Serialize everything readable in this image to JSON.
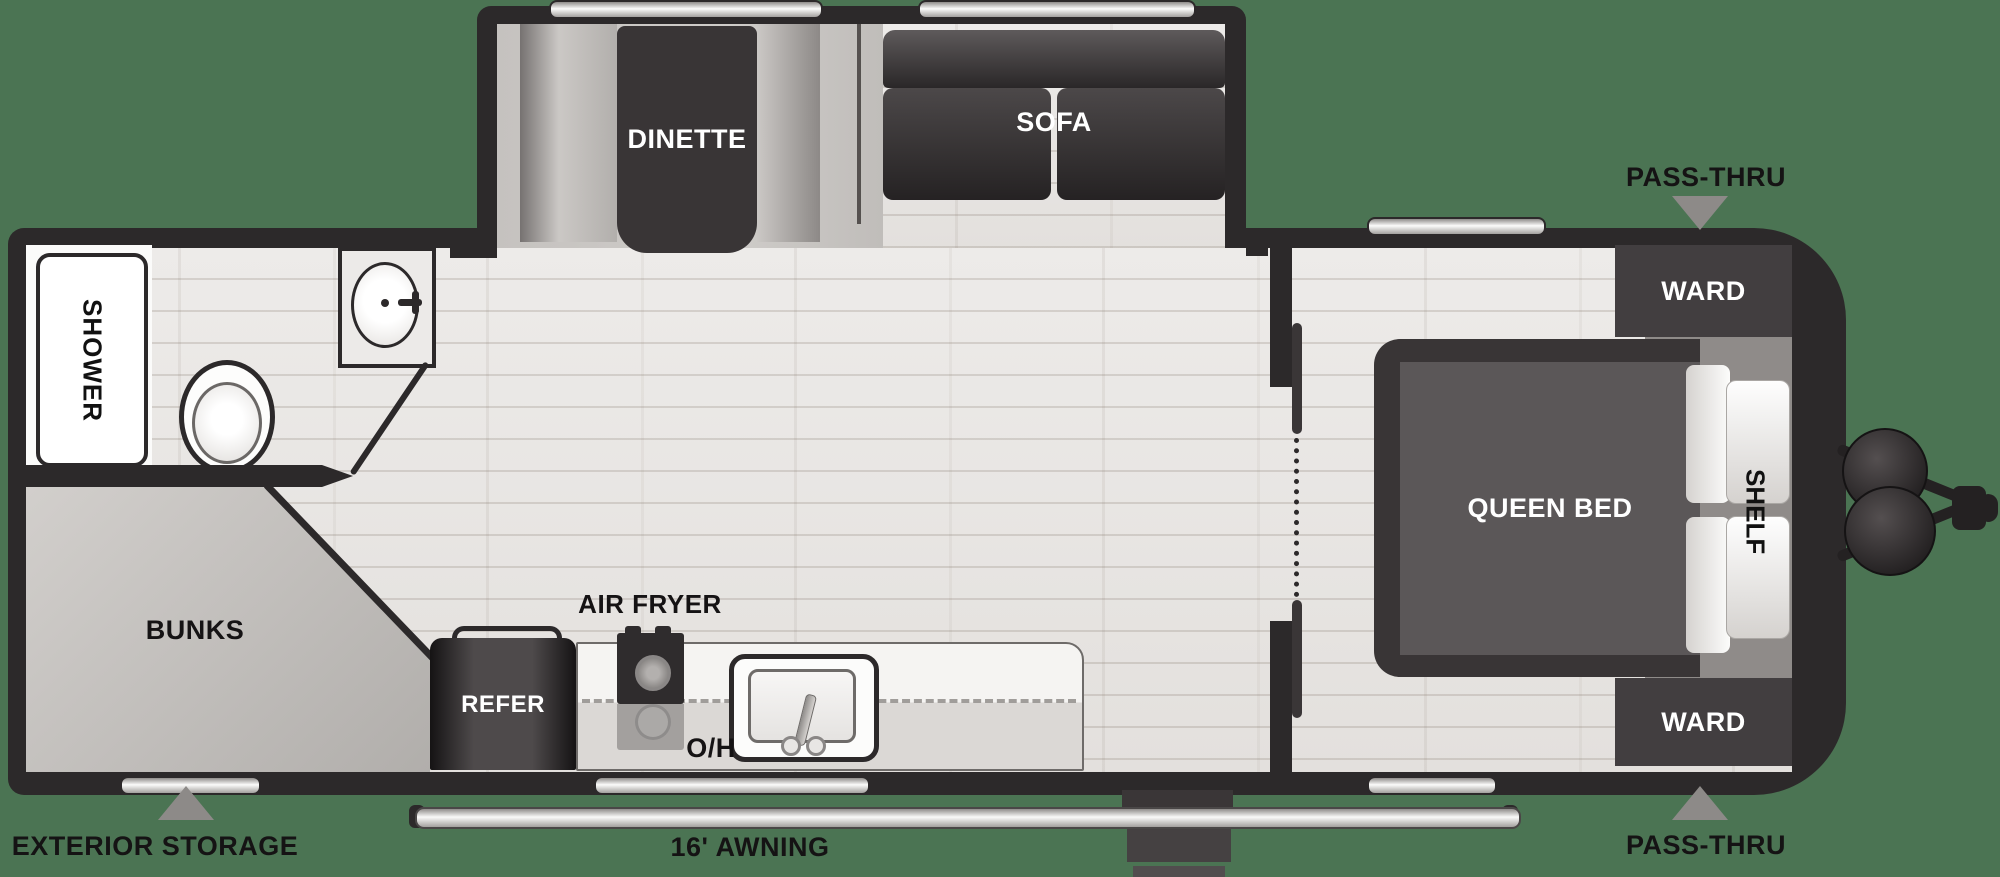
{
  "floorplan": {
    "title": "travel trailer floor plan",
    "colors": {
      "background": "#4b7453",
      "wall": "#2c292a",
      "furniture_dark": "#393536",
      "floor": "#eae8e6",
      "bunks_fill": "#c6c3c0",
      "callout_arrow": "#8d8a88",
      "window_silver": "#fbfbfa"
    },
    "labels": {
      "dinette": "DINETTE",
      "sofa": "SOFA",
      "shower": "SHOWER",
      "bunks": "BUNKS",
      "exterior_storage": "EXTERIOR STORAGE",
      "refer": "REFER",
      "air_fryer": "AIR FRYER",
      "overhead": "O/H",
      "awning": "16' AWNING",
      "queen_bed": "QUEEN BED",
      "shelf": "SHELF",
      "ward_top": "WARD",
      "ward_bottom": "WARD",
      "pass_thru_top": "PASS-THRU",
      "pass_thru_bottom": "PASS-THRU"
    }
  }
}
